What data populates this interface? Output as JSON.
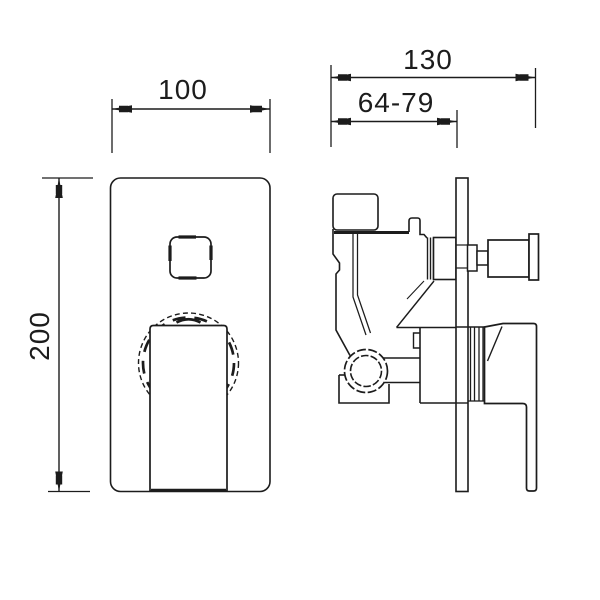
{
  "colors": {
    "background": "#ffffff",
    "line": "#1c1c1c"
  },
  "dimensions": {
    "width_label": "100",
    "height_label": "200",
    "depth_label": "130",
    "depth_range_label": "64-79"
  }
}
